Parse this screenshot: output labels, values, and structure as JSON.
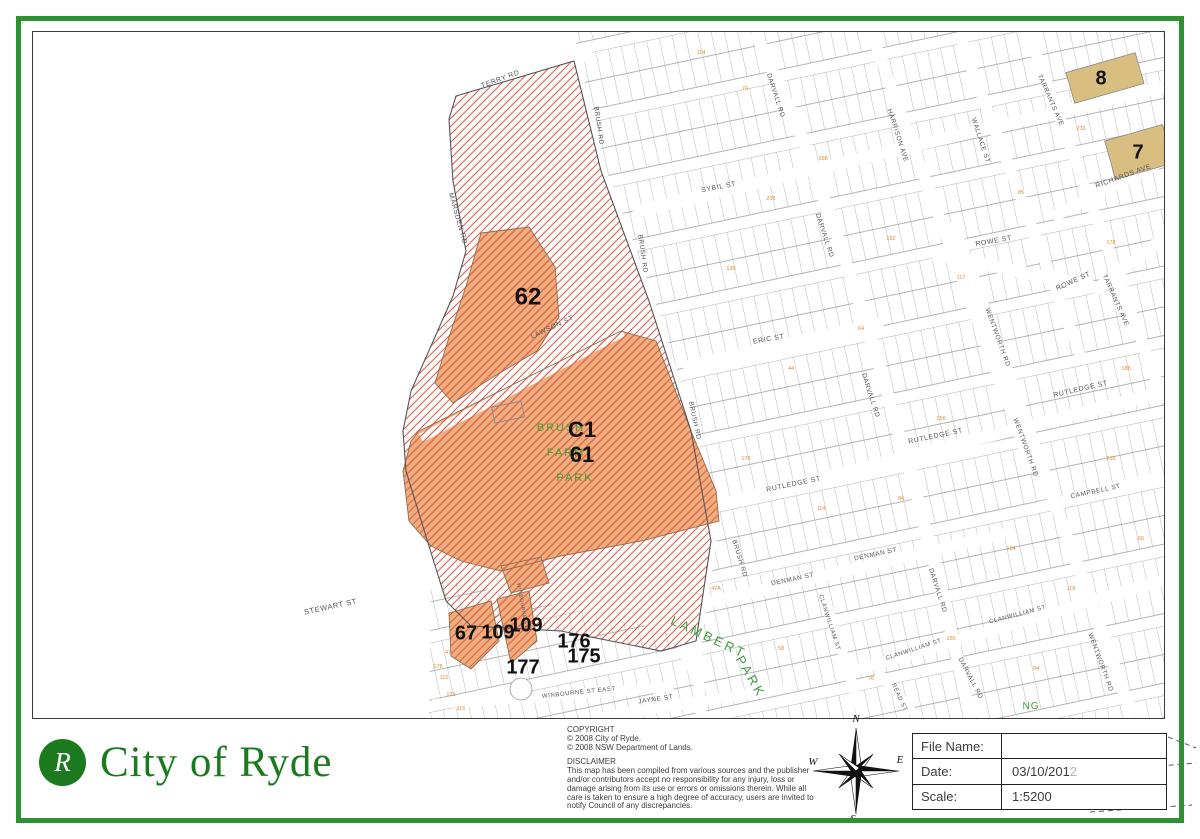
{
  "branding": {
    "logo_letter": "R",
    "org_name": "City of Ryde"
  },
  "footer": {
    "copyright": {
      "heading": "COPYRIGHT",
      "lines": [
        "© 2008 City of Ryde.",
        "© 2008 NSW Department of Lands."
      ]
    },
    "disclaimer": {
      "heading": "DISCLAIMER",
      "text": "This map has been compiled from various sources and the publisher and/or contributors accept no responsibility for any injury, loss or damage arising from its use or errors or omissions therein. While all care is taken to ensure a high degree of accuracy, users are invited to notify Council of any discrepancies."
    },
    "compass": {
      "labels": {
        "n": "N",
        "s": "S",
        "e": "E",
        "w": "W"
      }
    },
    "info_table": {
      "rows": [
        {
          "label": "File Name:",
          "value": "",
          "faded": ""
        },
        {
          "label": "Date:",
          "value": "03/10/201",
          "faded": "2"
        },
        {
          "label": "Scale:",
          "value": "1:5200",
          "faded": ""
        }
      ]
    }
  },
  "map": {
    "colors": {
      "hatch_line": "#dd5f4f",
      "zone_fill": "#f1ae7b",
      "zone_outline": "#8a6f52",
      "estate_outline": "#555555",
      "parcel_fill": "#d9be82",
      "parcel_outline": "#8a8a8a",
      "grid_line": "#9b9b9b",
      "street_text": "#555555",
      "park_text": "#3f9b3f",
      "lot_text": "#e08a30",
      "number_text": "#111111"
    },
    "street_labels": [
      {
        "t": "TERRY RD",
        "x": 468,
        "y": 49,
        "r": -20,
        "s": 7
      },
      {
        "t": "MARSDEN RD",
        "x": 423,
        "y": 187,
        "r": 74,
        "s": 7
      },
      {
        "t": "BRUSH RD",
        "x": 564,
        "y": 94,
        "r": 82,
        "s": 6.5
      },
      {
        "t": "BRUSH RD",
        "x": 608,
        "y": 222,
        "r": 82,
        "s": 6.5
      },
      {
        "t": "BRUSH RD",
        "x": 660,
        "y": 389,
        "r": 78,
        "s": 6.5
      },
      {
        "t": "BRUSH RD",
        "x": 705,
        "y": 527,
        "r": 73,
        "s": 6.5
      },
      {
        "t": "LAWSON ST",
        "x": 520,
        "y": 297,
        "r": -25,
        "s": 7
      },
      {
        "t": "SYBIL ST",
        "x": 686,
        "y": 157,
        "r": -11,
        "s": 7
      },
      {
        "t": "ROWE ST",
        "x": 961,
        "y": 211,
        "r": -10,
        "s": 7
      },
      {
        "t": "ROWE ST",
        "x": 1041,
        "y": 251,
        "r": -24,
        "s": 7
      },
      {
        "t": "ERIC ST",
        "x": 736,
        "y": 309,
        "r": -10,
        "s": 7
      },
      {
        "t": "RUTLEDGE ST",
        "x": 761,
        "y": 454,
        "r": -12,
        "s": 7
      },
      {
        "t": "RUTLEDGE ST",
        "x": 903,
        "y": 406,
        "r": -12,
        "s": 7
      },
      {
        "t": "RUTLEDGE ST",
        "x": 1048,
        "y": 359,
        "r": -13,
        "s": 7
      },
      {
        "t": "CAMPBELL ST",
        "x": 1063,
        "y": 461,
        "r": -12,
        "s": 6.5
      },
      {
        "t": "DENMAN ST",
        "x": 843,
        "y": 524,
        "r": -12,
        "s": 6.5
      },
      {
        "t": "DENMAN ST",
        "x": 760,
        "y": 549,
        "r": -12,
        "s": 6.5
      },
      {
        "t": "CLANWILLIAM ST",
        "x": 795,
        "y": 591,
        "r": 72,
        "s": 6
      },
      {
        "t": "CLANWILLIAM ST",
        "x": 881,
        "y": 619,
        "r": -18,
        "s": 6
      },
      {
        "t": "CLANWILLIAM ST",
        "x": 985,
        "y": 584,
        "r": -15,
        "s": 6
      },
      {
        "t": "READ ST",
        "x": 865,
        "y": 666,
        "r": 65,
        "s": 6
      },
      {
        "t": "WINBOURNE ST EAST",
        "x": 546,
        "y": 662,
        "r": -6,
        "s": 6
      },
      {
        "t": "JAYNE ST",
        "x": 623,
        "y": 669,
        "r": -8,
        "s": 6.5
      },
      {
        "t": "STEWART ST",
        "x": 298,
        "y": 577,
        "r": -12,
        "s": 7.5
      },
      {
        "t": "DARVALL RD",
        "x": 741,
        "y": 64,
        "r": 72,
        "s": 6.5
      },
      {
        "t": "DARVALL RD",
        "x": 790,
        "y": 204,
        "r": 72,
        "s": 6.5
      },
      {
        "t": "DARVALL RD",
        "x": 836,
        "y": 364,
        "r": 72,
        "s": 6.5
      },
      {
        "t": "DARVALL RD",
        "x": 903,
        "y": 559,
        "r": 72,
        "s": 6.5
      },
      {
        "t": "DARVALL RD",
        "x": 936,
        "y": 647,
        "r": 62,
        "s": 6.5
      },
      {
        "t": "HARRISON AVE",
        "x": 863,
        "y": 104,
        "r": 72,
        "s": 6.5
      },
      {
        "t": "WALLACE ST",
        "x": 946,
        "y": 109,
        "r": 72,
        "s": 6.5
      },
      {
        "t": "TARRANTS AVE",
        "x": 1016,
        "y": 69,
        "r": 66,
        "s": 6.5
      },
      {
        "t": "TARRANTS AVE",
        "x": 1081,
        "y": 269,
        "r": 66,
        "s": 6.5
      },
      {
        "t": "WENTWORTH RD",
        "x": 963,
        "y": 306,
        "r": 70,
        "s": 6.5
      },
      {
        "t": "WENTWORTH RD",
        "x": 991,
        "y": 416,
        "r": 70,
        "s": 6.5
      },
      {
        "t": "WENTWORTH RD",
        "x": 1066,
        "y": 631,
        "r": 70,
        "s": 6.5
      },
      {
        "t": "RICHARDS AVE",
        "x": 1091,
        "y": 146,
        "r": -20,
        "s": 7
      },
      {
        "t": "WINBOURNE ST",
        "x": 488,
        "y": 574,
        "r": 80,
        "s": 5
      }
    ],
    "park_labels": [
      {
        "t": "BRUSH",
        "x": 528,
        "y": 399,
        "r": 0,
        "s": 11,
        "ls": 2
      },
      {
        "t": "FARM",
        "x": 533,
        "y": 424,
        "r": 0,
        "s": 11,
        "ls": 2
      },
      {
        "t": "PARK",
        "x": 542,
        "y": 449,
        "r": 0,
        "s": 11,
        "ls": 2
      },
      {
        "t": "LAMBERT",
        "x": 674,
        "y": 609,
        "r": 25,
        "s": 13,
        "ls": 3
      },
      {
        "t": "PARK",
        "x": 714,
        "y": 647,
        "r": 60,
        "s": 13,
        "ls": 3
      },
      {
        "t": "NG",
        "x": 998,
        "y": 677,
        "r": 0,
        "s": 10,
        "ls": 1
      }
    ],
    "zone_labels": [
      {
        "t": "62",
        "x": 495,
        "y": 266,
        "s": 24
      },
      {
        "t": "C1",
        "x": 549,
        "y": 399,
        "s": 22
      },
      {
        "t": "61",
        "x": 549,
        "y": 424,
        "s": 22
      },
      {
        "t": "67",
        "x": 433,
        "y": 602,
        "s": 20
      },
      {
        "t": "109",
        "x": 465,
        "y": 601,
        "s": 20
      },
      {
        "t": "109",
        "x": 493,
        "y": 594,
        "s": 20
      },
      {
        "t": "176",
        "x": 541,
        "y": 610,
        "s": 20
      },
      {
        "t": "175",
        "x": 551,
        "y": 625,
        "s": 20
      },
      {
        "t": "177",
        "x": 490,
        "y": 636,
        "s": 20
      },
      {
        "t": "8",
        "x": 1068,
        "y": 47,
        "s": 20
      },
      {
        "t": "7",
        "x": 1105,
        "y": 121,
        "s": 20
      }
    ],
    "lot_numbers": [
      {
        "t": "47",
        "x": 415,
        "y": 622
      },
      {
        "t": "178",
        "x": 405,
        "y": 636
      },
      {
        "t": "110",
        "x": 411,
        "y": 647
      },
      {
        "t": "121",
        "x": 418,
        "y": 664
      },
      {
        "t": "115",
        "x": 428,
        "y": 678
      },
      {
        "t": "114",
        "x": 668,
        "y": 22
      },
      {
        "t": "74",
        "x": 712,
        "y": 58
      },
      {
        "t": "205",
        "x": 738,
        "y": 168
      },
      {
        "t": "139",
        "x": 698,
        "y": 238
      },
      {
        "t": "158",
        "x": 790,
        "y": 128
      },
      {
        "t": "192",
        "x": 858,
        "y": 208
      },
      {
        "t": "117",
        "x": 928,
        "y": 247
      },
      {
        "t": "85",
        "x": 988,
        "y": 162
      },
      {
        "t": "233",
        "x": 1048,
        "y": 98
      },
      {
        "t": "178",
        "x": 1078,
        "y": 212
      },
      {
        "t": "156",
        "x": 908,
        "y": 388
      },
      {
        "t": "64",
        "x": 828,
        "y": 298
      },
      {
        "t": "44",
        "x": 758,
        "y": 338
      },
      {
        "t": "176",
        "x": 713,
        "y": 428
      },
      {
        "t": "114",
        "x": 788,
        "y": 478
      },
      {
        "t": "84",
        "x": 868,
        "y": 468
      },
      {
        "t": "154",
        "x": 978,
        "y": 518
      },
      {
        "t": "118",
        "x": 1038,
        "y": 558
      },
      {
        "t": "150",
        "x": 918,
        "y": 608
      },
      {
        "t": "76",
        "x": 838,
        "y": 648
      },
      {
        "t": "58",
        "x": 748,
        "y": 618
      },
      {
        "t": "216",
        "x": 1078,
        "y": 428
      },
      {
        "t": "188",
        "x": 1093,
        "y": 338
      },
      {
        "t": "47A",
        "x": 683,
        "y": 558
      },
      {
        "t": "94",
        "x": 1003,
        "y": 638
      },
      {
        "t": "66",
        "x": 1108,
        "y": 508
      }
    ],
    "geometry": {
      "grid_regions": [
        [
          [
            545,
            0
          ],
          [
            1131,
            0
          ],
          [
            1131,
            686
          ],
          [
            640,
            686
          ],
          [
            663,
            609
          ],
          [
            678,
            509
          ],
          [
            658,
            399
          ],
          [
            616,
            269
          ],
          [
            568,
            139
          ],
          [
            541,
            29
          ]
        ],
        [
          [
            398,
            545
          ],
          [
            530,
            575
          ],
          [
            640,
            600
          ],
          [
            668,
            686
          ],
          [
            396,
            686
          ]
        ]
      ],
      "corridors": [
        {
          "w": 10,
          "pts": [
            [
              400,
              70
            ],
            [
              560,
              22
            ]
          ]
        },
        {
          "w": 12,
          "pts": [
            [
              600,
              180
            ],
            [
              1131,
              55
            ]
          ]
        },
        {
          "w": 12,
          "pts": [
            [
              900,
              222
            ],
            [
              1000,
              242
            ],
            [
              1065,
              256
            ],
            [
              1131,
              206
            ]
          ]
        },
        {
          "w": 11,
          "pts": [
            [
              1020,
              185
            ],
            [
              1131,
              128
            ]
          ]
        },
        {
          "w": 11,
          "pts": [
            [
              650,
              335
            ],
            [
              850,
              290
            ]
          ]
        },
        {
          "w": 12,
          "pts": [
            [
              655,
              480
            ],
            [
              1131,
              360
            ]
          ]
        },
        {
          "w": 10,
          "pts": [
            [
              1005,
              475
            ],
            [
              1131,
              443
            ]
          ]
        },
        {
          "w": 11,
          "pts": [
            [
              655,
              575
            ],
            [
              980,
              500
            ]
          ]
        },
        {
          "w": 11,
          "pts": [
            [
              815,
              640
            ],
            [
              1131,
              548
            ]
          ]
        },
        {
          "w": 10,
          "pts": [
            [
              400,
              672
            ],
            [
              640,
              655
            ]
          ]
        },
        {
          "w": 10,
          "pts": [
            [
              560,
              686
            ],
            [
              760,
              655
            ]
          ]
        },
        {
          "w": 11,
          "pts": [
            [
              541,
              29
            ],
            [
              568,
              139
            ],
            [
              616,
              269
            ],
            [
              658,
              399
            ],
            [
              678,
              509
            ],
            [
              663,
              609
            ],
            [
              668,
              686
            ]
          ]
        },
        {
          "w": 12,
          "pts": [
            [
              722,
              0
            ],
            [
              765,
              95
            ],
            [
              808,
              215
            ],
            [
              845,
              330
            ],
            [
              880,
              450
            ],
            [
              905,
              545
            ],
            [
              938,
              686
            ]
          ]
        },
        {
          "w": 11,
          "pts": [
            [
              838,
              0
            ],
            [
              1000,
              440
            ]
          ]
        },
        {
          "w": 11,
          "pts": [
            [
              925,
              0
            ],
            [
              1050,
              330
            ]
          ]
        },
        {
          "w": 11,
          "pts": [
            [
              995,
              0
            ],
            [
              1131,
              370
            ]
          ]
        },
        {
          "w": 12,
          "pts": [
            [
              920,
              190
            ],
            [
              1100,
              686
            ]
          ]
        },
        {
          "w": 10,
          "pts": [
            [
              790,
              560
            ],
            [
              830,
              686
            ]
          ]
        },
        {
          "w": 9,
          "pts": [
            [
              845,
              640
            ],
            [
              885,
              686
            ]
          ]
        }
      ],
      "lawson_corridor": {
        "w": 9,
        "pts": [
          [
            388,
            406
          ],
          [
            590,
            300
          ]
        ]
      },
      "estate_polygon": [
        [
          423,
          64
        ],
        [
          541,
          29
        ],
        [
          568,
          139
        ],
        [
          616,
          269
        ],
        [
          658,
          399
        ],
        [
          678,
          509
        ],
        [
          663,
          609
        ],
        [
          628,
          619
        ],
        [
          528,
          599
        ],
        [
          438,
          594
        ],
        [
          413,
          569
        ],
        [
          396,
          514
        ],
        [
          373,
          439
        ],
        [
          370,
          399
        ],
        [
          378,
          359
        ],
        [
          398,
          314
        ],
        [
          420,
          264
        ],
        [
          433,
          219
        ],
        [
          420,
          149
        ],
        [
          416,
          87
        ]
      ],
      "orange_zones": [
        [
          [
            448,
            201
          ],
          [
            496,
            195
          ],
          [
            522,
            235
          ],
          [
            526,
            285
          ],
          [
            504,
            319
          ],
          [
            460,
            345
          ],
          [
            420,
            371
          ],
          [
            402,
            351
          ],
          [
            416,
            305
          ],
          [
            434,
            251
          ]
        ],
        [
          [
            386,
            399
          ],
          [
            588,
            299
          ],
          [
            623,
            309
          ],
          [
            658,
            399
          ],
          [
            683,
            459
          ],
          [
            686,
            489
          ],
          [
            608,
            509
          ],
          [
            528,
            524
          ],
          [
            468,
            539
          ],
          [
            428,
            529
          ],
          [
            398,
            514
          ],
          [
            376,
            489
          ],
          [
            370,
            439
          ],
          [
            378,
            409
          ]
        ],
        [
          [
            416,
            581
          ],
          [
            458,
            569
          ],
          [
            466,
            609
          ],
          [
            438,
            637
          ],
          [
            418,
            624
          ]
        ],
        [
          [
            464,
            567
          ],
          [
            496,
            559
          ],
          [
            504,
            609
          ],
          [
            478,
            631
          ]
        ],
        [
          [
            468,
            534
          ],
          [
            508,
            525
          ],
          [
            516,
            551
          ],
          [
            478,
            561
          ]
        ]
      ],
      "tan_parcels": [
        {
          "cx": 1072,
          "cy": 46,
          "w": 72,
          "h": 32,
          "rot": -16
        },
        {
          "cx": 1106,
          "cy": 120,
          "w": 60,
          "h": 40,
          "rot": -16
        }
      ],
      "building": {
        "cx": 475,
        "cy": 380,
        "w": 30,
        "h": 16,
        "rot": -12
      },
      "culdesac": {
        "cx": 488,
        "cy": 657,
        "r": 11
      },
      "footer_dashes": [
        [
          [
            1168,
            737
          ],
          [
            1196,
            748
          ]
        ],
        [
          [
            1088,
            772
          ],
          [
            1196,
            763
          ]
        ],
        [
          [
            1090,
            812
          ],
          [
            1192,
            805
          ]
        ]
      ]
    }
  }
}
